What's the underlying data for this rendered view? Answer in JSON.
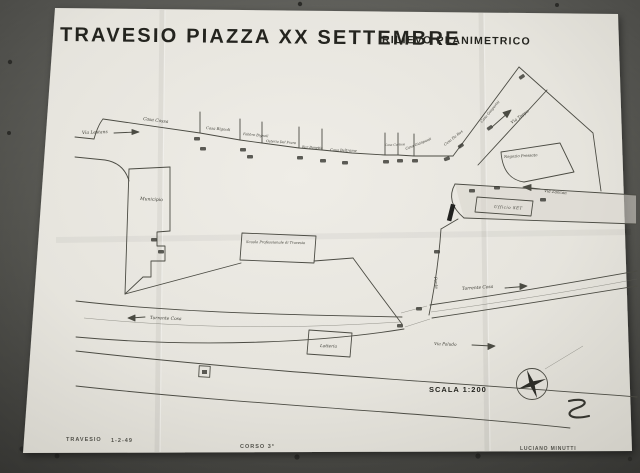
{
  "title": {
    "main": "TRAVESIO PIAZZA XX SETTEMBRE",
    "subtitle": "RILIEVO PLANIMETRICO"
  },
  "labels": {
    "via_lestans": "Via Lestans",
    "casa_cossa": "Casa Cossa",
    "casa_bignoli": "Casa Bignoli",
    "fabbro_bignoli": "Fabbro Bignoli",
    "osteria_del_frare": "Osteria Del Frare",
    "bar_bonetta": "Bar Bonetta",
    "casa_beltrame": "Casa Beltrame",
    "casa_curtissi": "Casa Curtissi",
    "casa_gianpaoli": "Casa Gianpaoli",
    "casa_da_ros": "Casa Da Ros",
    "casa_gasparini": "Casa Gasparini",
    "via_toppo": "Via Toppo",
    "negozio_pressato": "Negozio Pressato",
    "via_zancan": "Via Zancan",
    "ufficio_set": "Ufficio SET",
    "municipio": "Municipio",
    "scuola": "Scuola Professionale di Travesio",
    "torrente_cosa": "Torrente Cosa",
    "ponte": "Ponte",
    "latteria": "Latteria",
    "via_paludo": "Via Paludo",
    "scala": "SCALA 1:200"
  },
  "footer": {
    "place": "TRAVESIO",
    "date": "1-2-49",
    "course": "CORSO 3°",
    "author": "LUCIANO MINUTTI"
  },
  "colors": {
    "wall": "#55554f",
    "paper": "#e8e6df",
    "ink": "#4b4b43",
    "title_ink": "#24241f"
  }
}
